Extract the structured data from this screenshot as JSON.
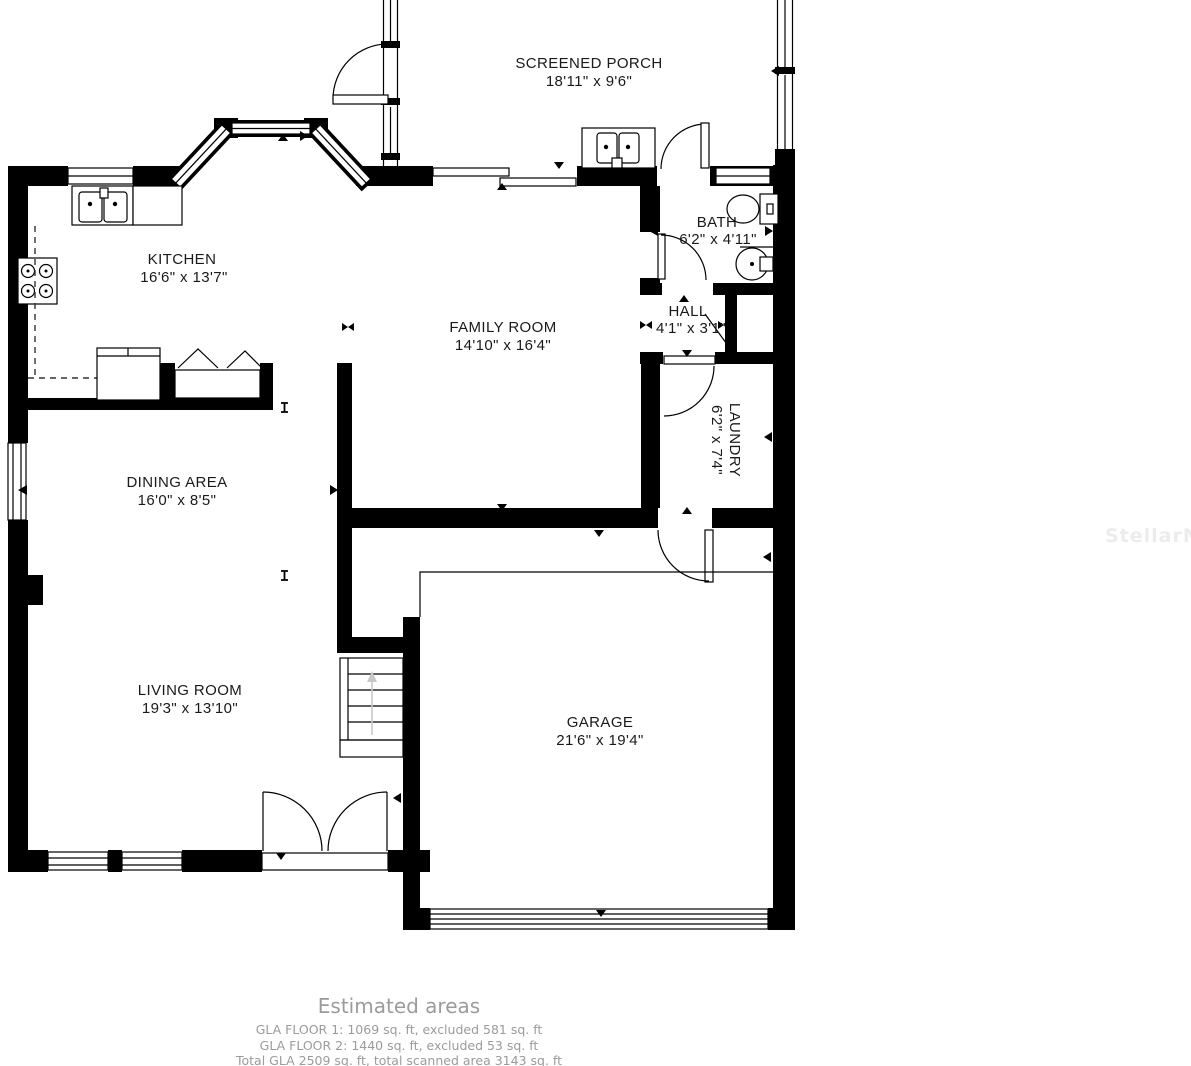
{
  "floor_plan": {
    "rooms": {
      "screened_porch": {
        "name": "SCREENED PORCH",
        "dims": "18'11\" x 9'6\""
      },
      "kitchen": {
        "name": "KITCHEN",
        "dims": "16'6\" x 13'7\""
      },
      "bath": {
        "name": "BATH",
        "dims": "6'2\" x 4'11\""
      },
      "family_room": {
        "name": "FAMILY ROOM",
        "dims": "14'10\" x 16'4\""
      },
      "hall": {
        "name": "HALL",
        "dims": "4'1\" x 3'1\""
      },
      "laundry": {
        "name": "LAUNDRY",
        "dims": "6'2\" x 7'4\""
      },
      "dining_area": {
        "name": "DINING AREA",
        "dims": "16'0\" x 8'5\""
      },
      "living_room": {
        "name": "LIVING ROOM",
        "dims": "19'3\" x 13'10\""
      },
      "garage": {
        "name": "GARAGE",
        "dims": "21'6\" x 19'4\""
      }
    },
    "estimated_areas": {
      "title": "Estimated areas",
      "lines": [
        "GLA FLOOR 1: 1069 sq. ft, excluded 581 sq. ft",
        "GLA FLOOR 2: 1440 sq. ft, excluded 53 sq. ft",
        "Total GLA 2509 sq. ft, total scanned area 3143 sq. ft"
      ]
    },
    "watermark": "StellarMLS",
    "colors": {
      "wall": "#000000",
      "label_text": "#1a1a1a",
      "muted_text": "#9b9b9b",
      "watermark_text": "#ececec",
      "stairs_arrow": "#c8c8c8"
    }
  }
}
